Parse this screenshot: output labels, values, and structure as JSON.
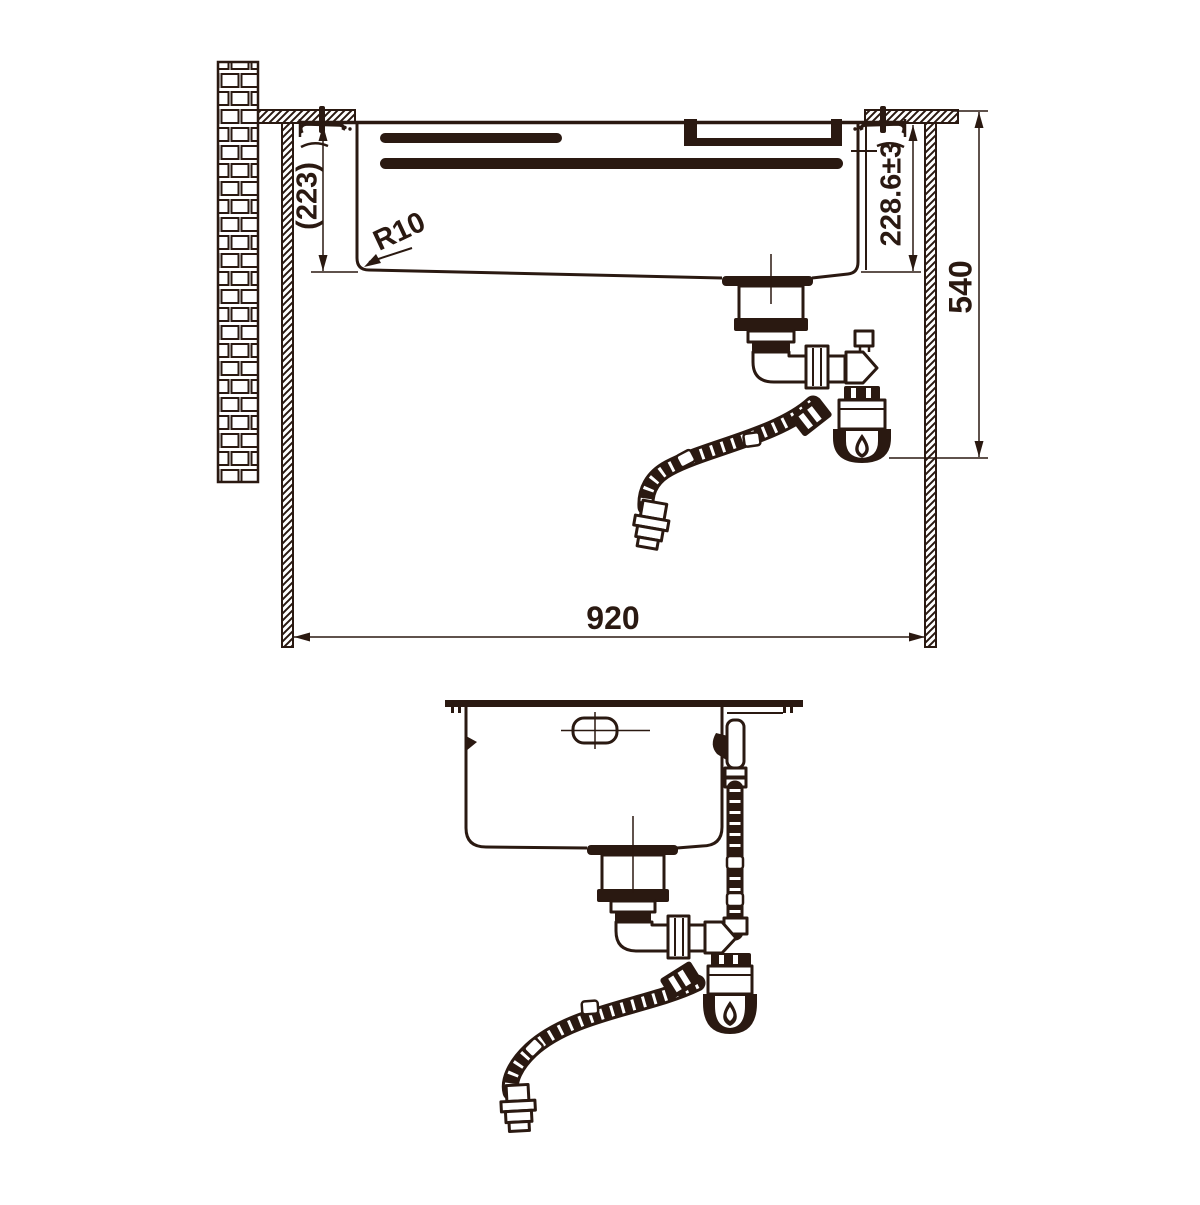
{
  "drawing": {
    "ink_color": "#2a1911",
    "background_color": "#ffffff"
  },
  "front_view": {
    "dim_depth_ref": "(223)",
    "dim_corner_radius": "R10",
    "dim_bowl_depth": "228.6±3",
    "dim_worktop_height": "540",
    "dim_cabinet_width": "920"
  }
}
